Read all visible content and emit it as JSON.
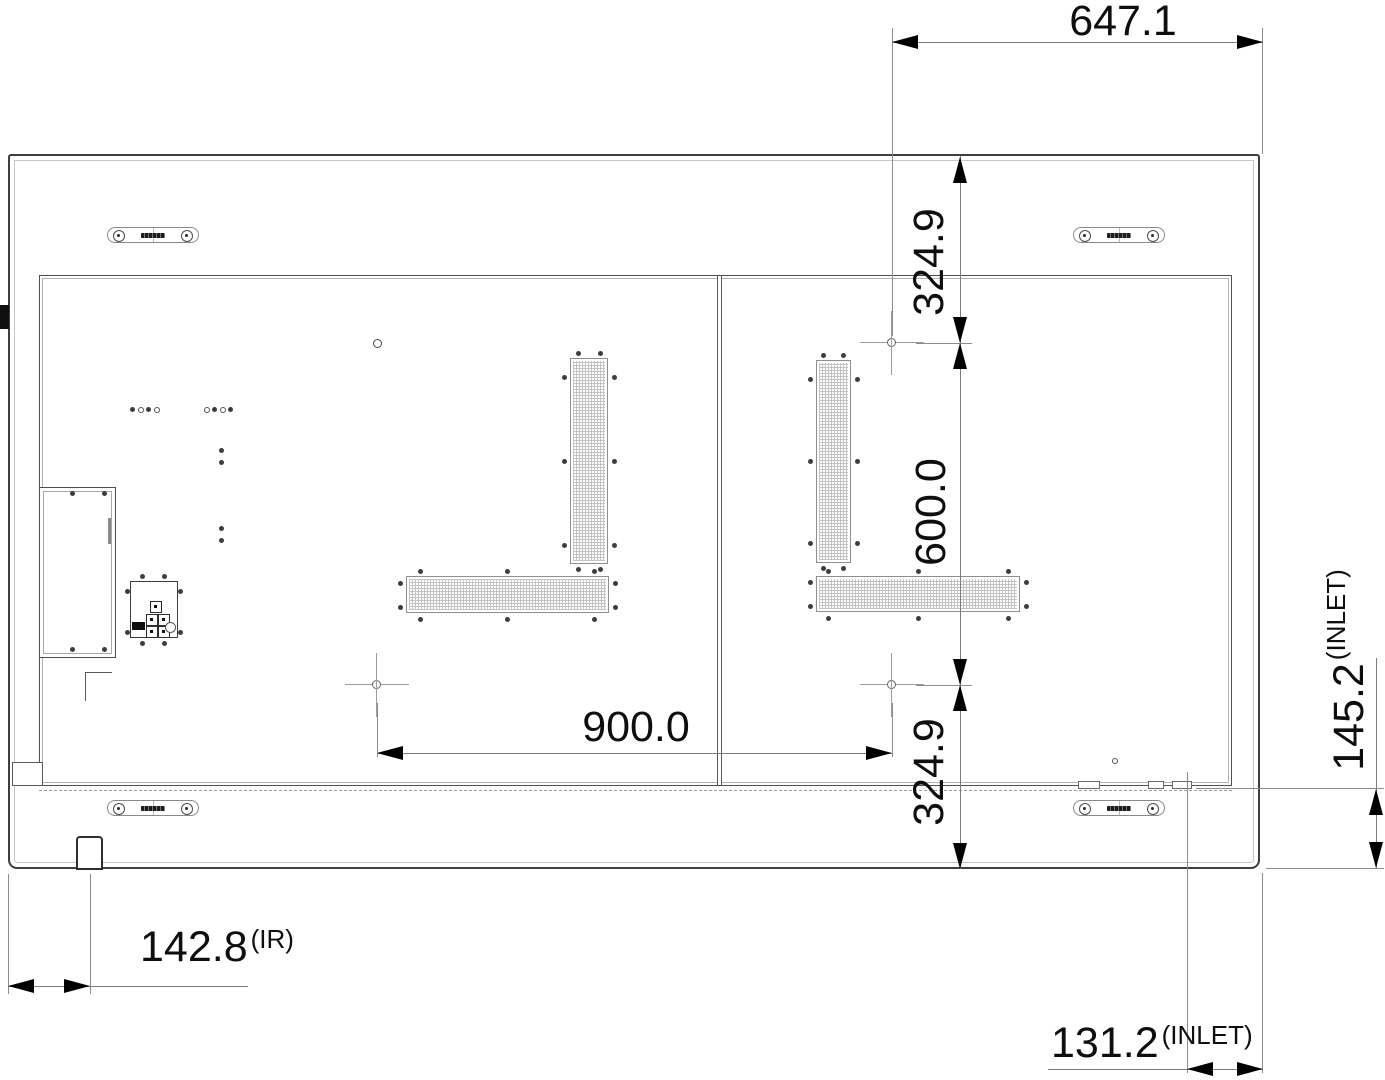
{
  "drawing": {
    "kind": "dimensional technical drawing",
    "subject": "display rear view with mounting and port dimensions"
  },
  "dimensions": {
    "top_width": "647.1",
    "mount_top_offset": "324.9",
    "mount_height": "600.0",
    "mount_bottom_offset": "324.9",
    "mount_width": "900.0",
    "inlet_height": "145.2",
    "inlet_height_suffix": "(INLET)",
    "ir_offset": "142.8",
    "ir_suffix": "(IR)",
    "inlet_side_offset": "131.2",
    "inlet_side_suffix": "(INLET)"
  },
  "components": [
    "outer-panel",
    "back-cover",
    "center-seam",
    "mounting-handle",
    "vent-grille",
    "vesa-mount-hole",
    "terminal-bay",
    "control-button-cluster",
    "ir-sensor",
    "ac-inlet-centerline",
    "screw-hole"
  ],
  "colors": {
    "background": "#ffffff",
    "panel_line": "#3f3f3f",
    "light_line": "#b2b2b2",
    "dim_line": "#7c7c7c",
    "arrow": "#000000",
    "text": "#0e0e0e",
    "mesh": "#c3c3c3"
  }
}
